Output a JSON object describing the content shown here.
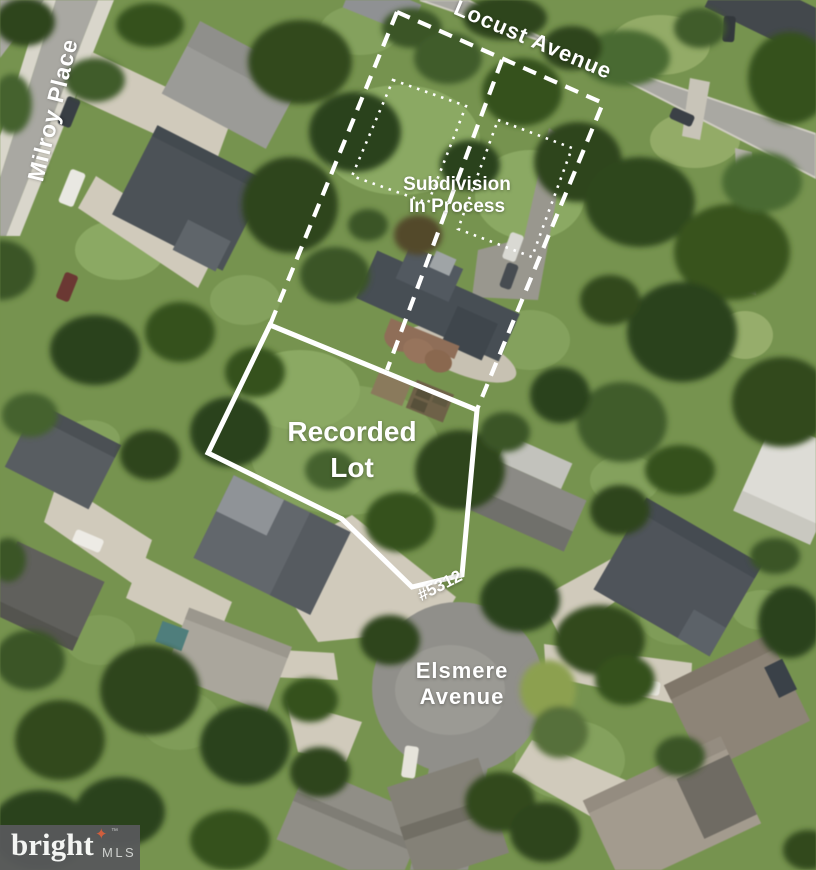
{
  "theme": {
    "annotation_color": "#ffffff",
    "logo_bg": "#58595b",
    "logo_star": "#d9603f",
    "logo_text": "#ffffff",
    "logo_mls": "#d4d5d6"
  },
  "streets": {
    "milroy": "Milroy Place",
    "locust": "Locust Avenue",
    "elsmere_line1": "Elsmere",
    "elsmere_line2": "Avenue"
  },
  "annotations": {
    "subdivision_line1": "Subdivision",
    "subdivision_line2": "In Process",
    "recorded_line1": "Recorded",
    "recorded_line2": "Lot",
    "house_number": "#5312"
  },
  "logo": {
    "brand": "bright",
    "suffix": "MLS",
    "trademark": "™",
    "star_icon": "four-pointed-star"
  }
}
